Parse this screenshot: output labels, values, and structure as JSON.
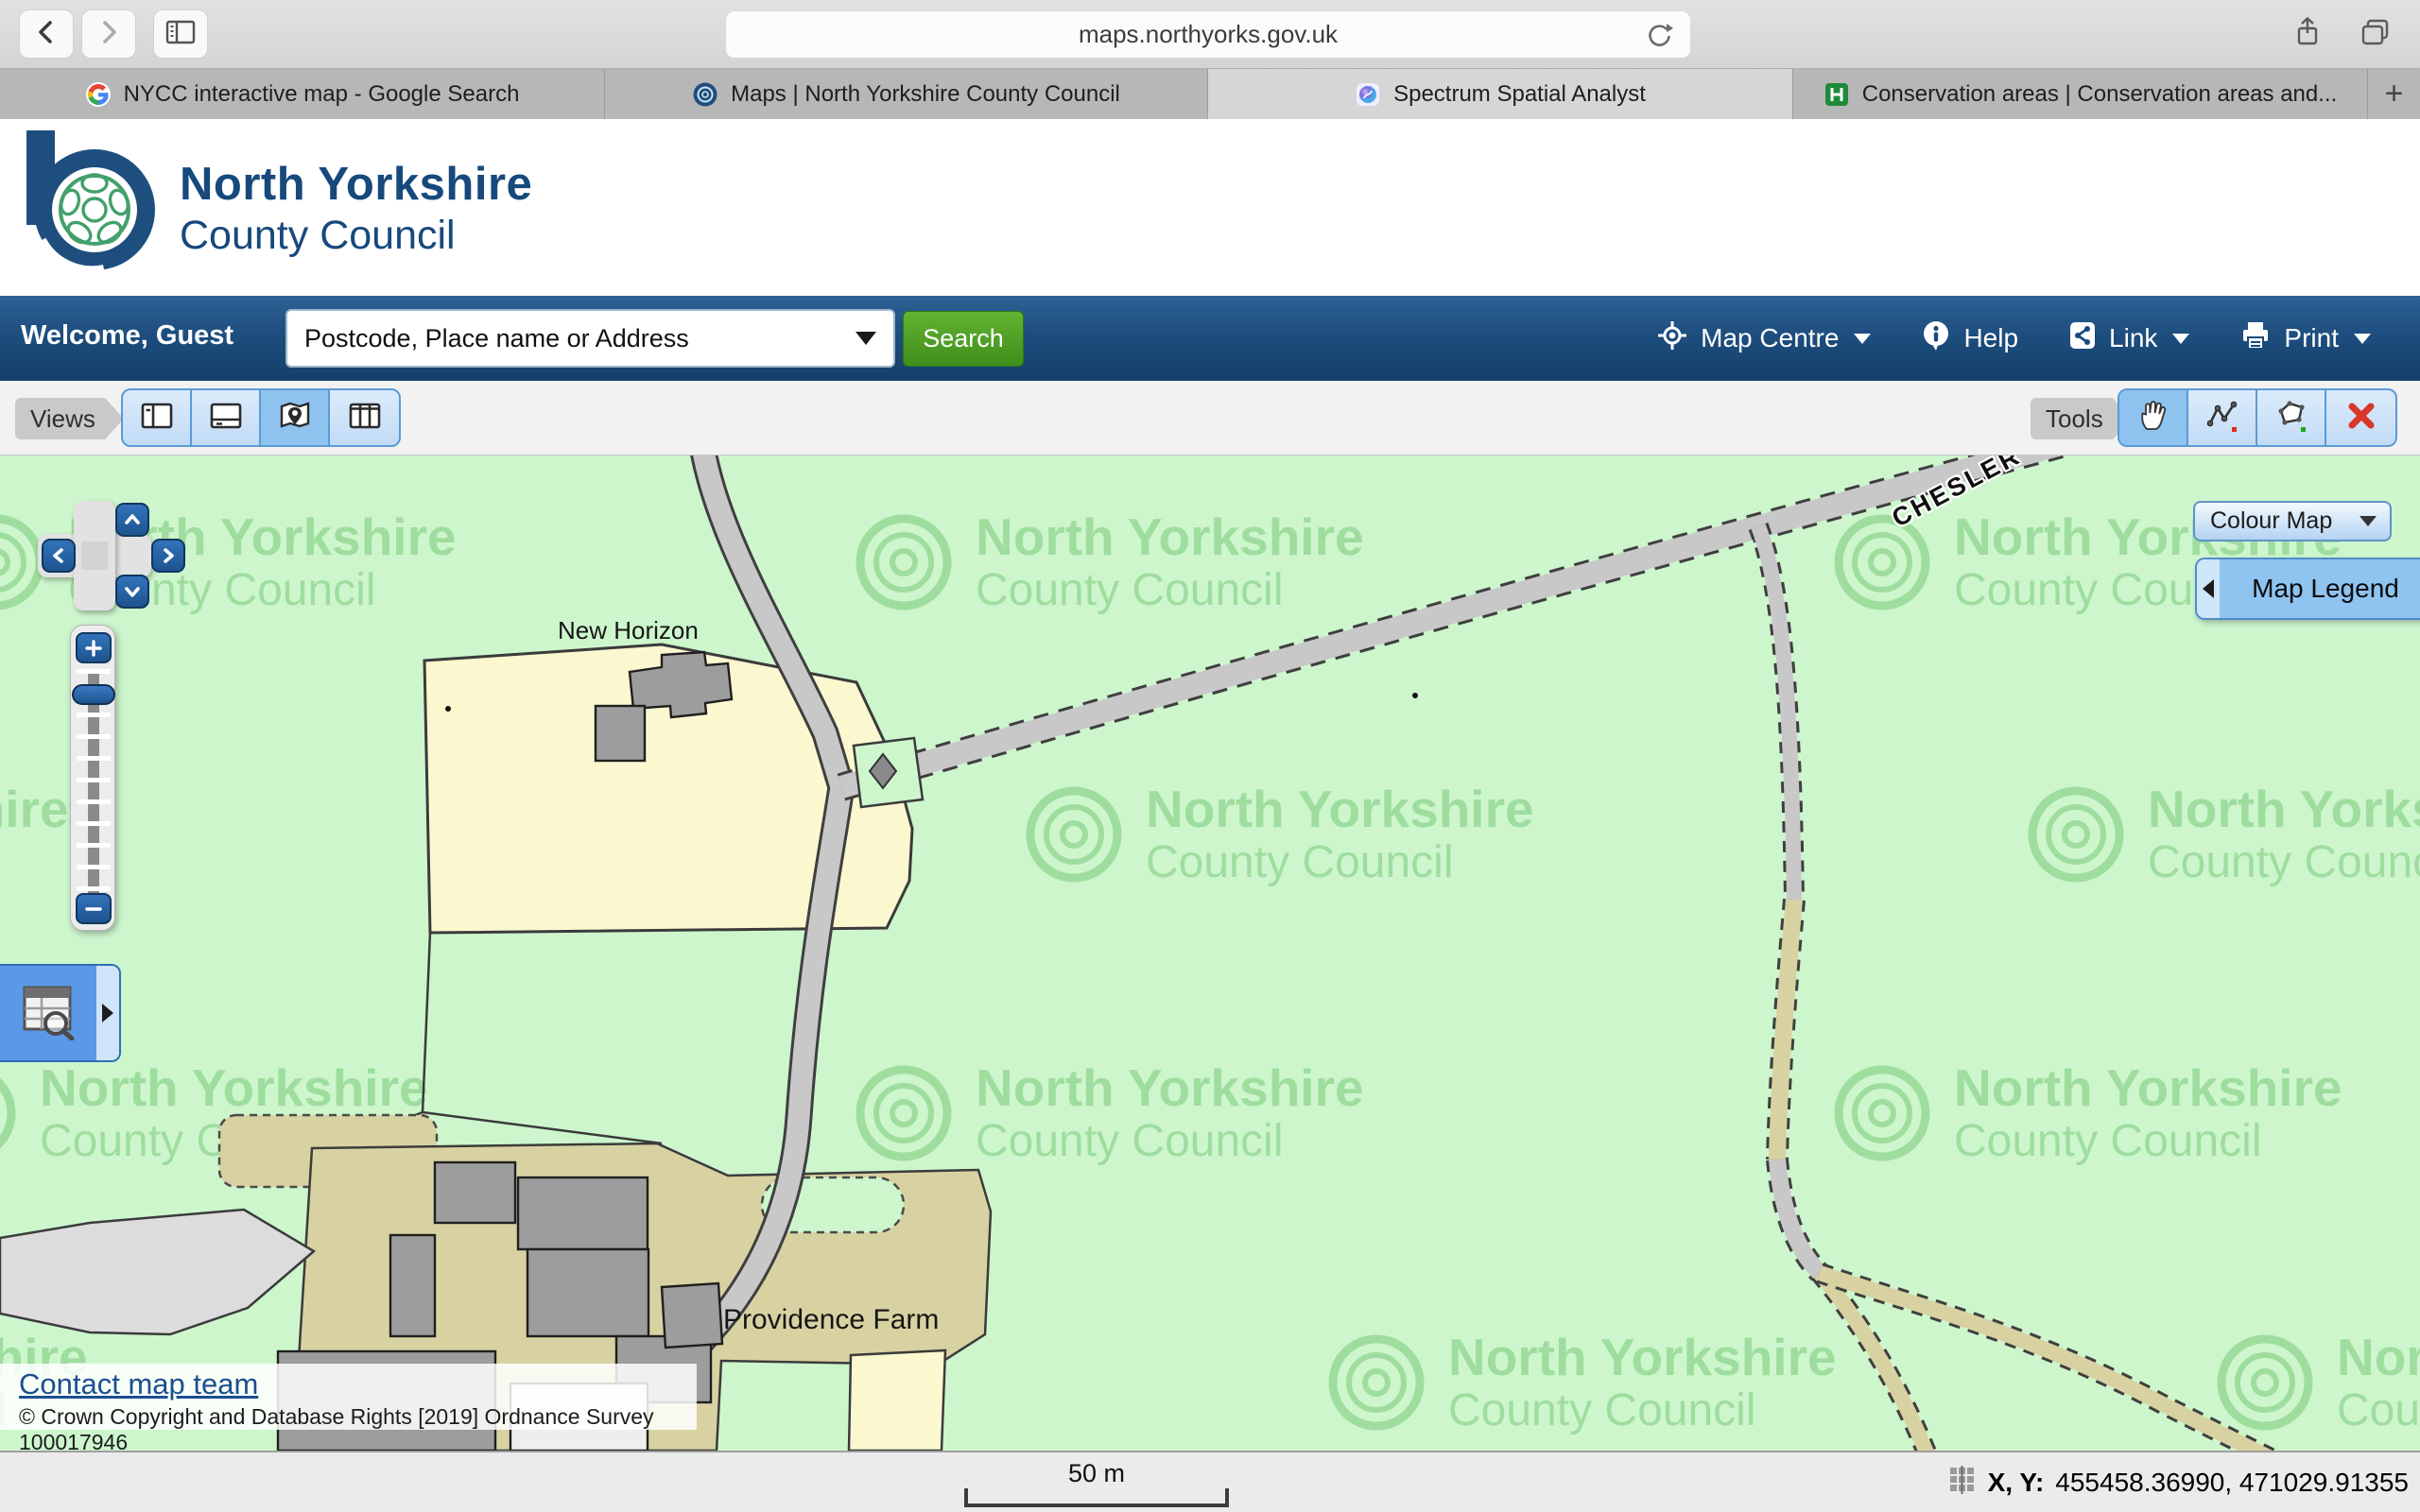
{
  "browser": {
    "url": "maps.northyorks.gov.uk",
    "new_tab": "+",
    "tabs": [
      {
        "title": "NYCC interactive map - Google Search",
        "icon": "google-icon"
      },
      {
        "title": "Maps | North Yorkshire County Council",
        "icon": "nycc-rose-icon"
      },
      {
        "title": "Spectrum Spatial Analyst",
        "icon": "spectrum-icon",
        "active": true
      },
      {
        "title": "Conservation areas | Conservation areas and...",
        "icon": "sharepoint-icon"
      }
    ]
  },
  "header": {
    "logo_line1": "North Yorkshire",
    "logo_line2": "County Council"
  },
  "navbar": {
    "welcome": "Welcome, Guest",
    "search_placeholder": "Postcode, Place name or Address",
    "search_button": "Search",
    "items": [
      {
        "label": "Map Centre",
        "icon": "map-centre-icon",
        "caret": true
      },
      {
        "label": "Help",
        "icon": "info-icon",
        "caret": false
      },
      {
        "label": "Link",
        "icon": "share-link-icon",
        "caret": true
      },
      {
        "label": "Print",
        "icon": "printer-icon",
        "caret": true
      }
    ]
  },
  "toolbar": {
    "views_label": "Views",
    "tools_label": "Tools",
    "view_buttons": [
      "layout-left-panel",
      "layout-bottom-panel",
      "map-view",
      "layout-columns"
    ],
    "tool_buttons": [
      "pan-hand",
      "measure-line",
      "measure-area",
      "clear"
    ]
  },
  "map": {
    "colour_map": "Colour Map",
    "legend": "Map Legend",
    "watermark": {
      "line1": "North Yorkshire",
      "line2": "County Council"
    },
    "labels": {
      "new_horizon": "New Horizon",
      "providence_farm": "Providence Farm",
      "street": "CHESLER"
    },
    "contact_link": "Contact map team",
    "copyright": "© Crown Copyright and Database Rights [2019] Ordnance Survey 100017946",
    "colors": {
      "background": "#cdf6cd",
      "parcel_yellow": "#fbf8d0",
      "parcel_tan": "#d8d2a2",
      "road_grey": "#c8c8c8",
      "building_grey": "#9d9d9d",
      "accent_blue": "#5b9bd5",
      "navy": "#17497c",
      "button_green": "#4f9e2a"
    }
  },
  "statusbar": {
    "scale": "50 m",
    "coords_label": "X, Y:",
    "coords_value": "455458.36990, 471029.91355"
  }
}
